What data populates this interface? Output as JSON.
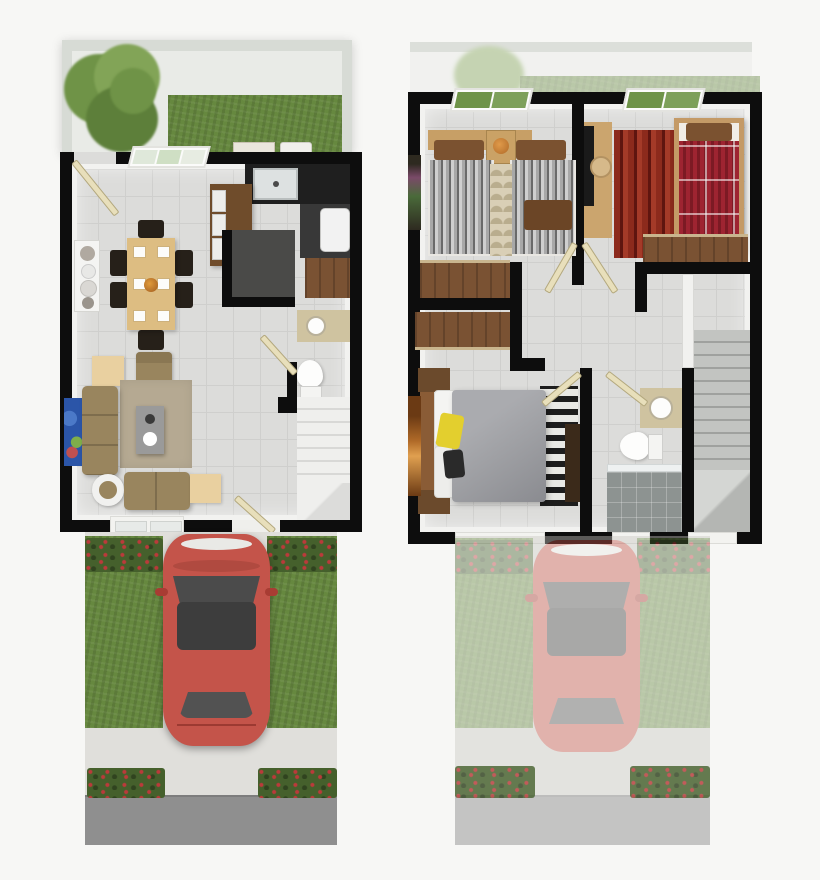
{
  "palette": {
    "bg": "#f7f7f5",
    "wall": "#0d0d0d",
    "fence": "#d7dbd5",
    "patio": "#e9ebe7",
    "floor": "#dcdcda",
    "floorLine": "#cfcfcd",
    "baseboard": "#f2f2f0",
    "grass": "#66883f",
    "hedge": "#45602c",
    "flower": "#bb3a3a",
    "concrete": "#e0dfdb",
    "road": "#8f8f8f",
    "stairs": "#efefed",
    "stairEdge": "#d8d8d6",
    "counter": "#1f1f1f",
    "nook": "#383838",
    "storage": "#4a4a48",
    "island": "#6f4c2b",
    "wood": "#7a5233",
    "tableWood": "#ddbd82",
    "chair": "#262019",
    "shelf": "#f4f4f2",
    "sofa": "#99855e",
    "rugLiving": "#b5a992",
    "coffeeTable": "#9a9a9a",
    "sideTable": "#e9d0a0",
    "artBlue": "#2b55a8",
    "vanity": "#cfc3a0",
    "duvetA": "#a8a8a8",
    "duvetB": "#6a6a6a",
    "pillowBrown": "#7b5230",
    "headboard": "#c79f66",
    "scaleRug": "#d9cfb6",
    "scaleRugDark": "#b9ad8e",
    "redBed": "#9e2431",
    "redBedDark": "#7c1a24",
    "redRugA": "#8c2a1c",
    "redRugB": "#5f150f",
    "deskWood": "#cba56e",
    "masterBed": "#9fa0a4",
    "yellowPillow": "#e3cf2e",
    "dresser": "#3b2a1a",
    "artOrange": "#b06a28",
    "showerFloor": "#8d9391",
    "doorCream": "#e8dfbb",
    "carBody": "#c4544a",
    "carGlass": "#4b4b4b",
    "carRoof": "#3d3d3d",
    "treeA": "#6f9347",
    "treeB": "#82a457",
    "treeC": "#5d7f3a",
    "washer": "#f2f2f2"
  },
  "scene": {
    "type": "floor-plan-render",
    "view": "top-down-3d",
    "panels": [
      {
        "id": "ground-floor",
        "areas": [
          "backyard",
          "kitchen",
          "dining-room",
          "living-room",
          "powder-room",
          "storage-closet",
          "stairs",
          "driveway",
          "street"
        ],
        "objects": [
          "tree",
          "grass-strip",
          "kitchen-island",
          "sink",
          "washer",
          "dining-table",
          "chairs",
          "sideboard",
          "sofa",
          "loveseat",
          "armchair",
          "coffee-table",
          "rug",
          "blue-wall-art",
          "toilet",
          "vanity-sink",
          "red-car",
          "flower-hedges"
        ]
      },
      {
        "id": "upper-floor",
        "areas": [
          "bedroom-1",
          "bedroom-2",
          "master-bedroom",
          "bathroom",
          "hallway",
          "stairs",
          "driveway-faded"
        ],
        "objects": [
          "twin-beds",
          "nightstand-lamp",
          "scale-rug",
          "wardrobes",
          "desk",
          "desk-chair",
          "tv",
          "red-single-bed",
          "red-striped-rug",
          "double-bed",
          "yellow-pillow",
          "zebra-rug",
          "dresser",
          "toilet",
          "vanity-sink",
          "shower",
          "red-car-faded",
          "flower-hedges"
        ]
      }
    ]
  }
}
